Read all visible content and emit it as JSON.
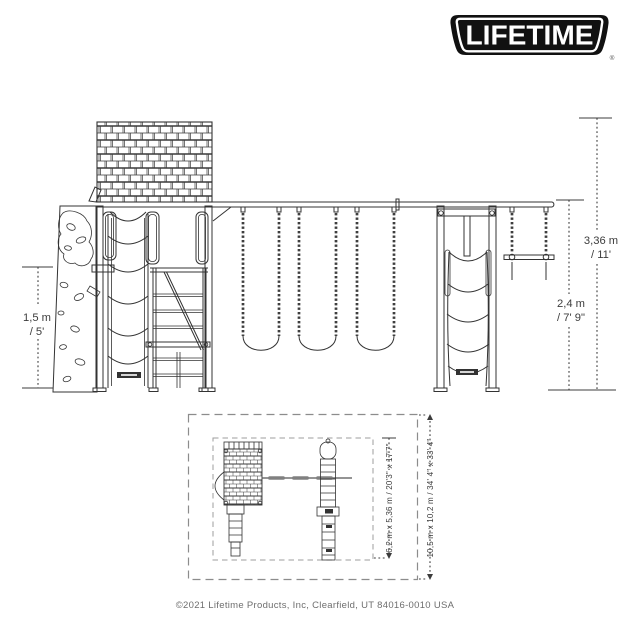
{
  "logo": {
    "text": "LIFETIME",
    "registered_mark": "®"
  },
  "side_view": {
    "platform_height": {
      "metric": "1,5 m",
      "imperial": "/ 5'"
    },
    "beam_height": {
      "metric": "2,4 m",
      "imperial": "/ 7' 9\""
    },
    "overall_height": {
      "metric": "3,36 m",
      "imperial": "/ 11'"
    }
  },
  "top_view": {
    "frame_footprint": "6,2 m x 5,36 m / 20'3\" x 17'7\"",
    "clearance_zone": "10,5 m x 10,2 m / 34' 4\" x 33' 4\""
  },
  "footer": {
    "copyright": "©2021 Lifetime Products, Inc, Clearfield, UT 84016-0010 USA"
  },
  "colors": {
    "drawing_line": "#333333",
    "dimension_text": "#3c3c3c",
    "dashed_boundary": "#8c8c8c",
    "logo_black": "#111111",
    "footer_text": "#6e6e6e",
    "background": "#ffffff"
  }
}
